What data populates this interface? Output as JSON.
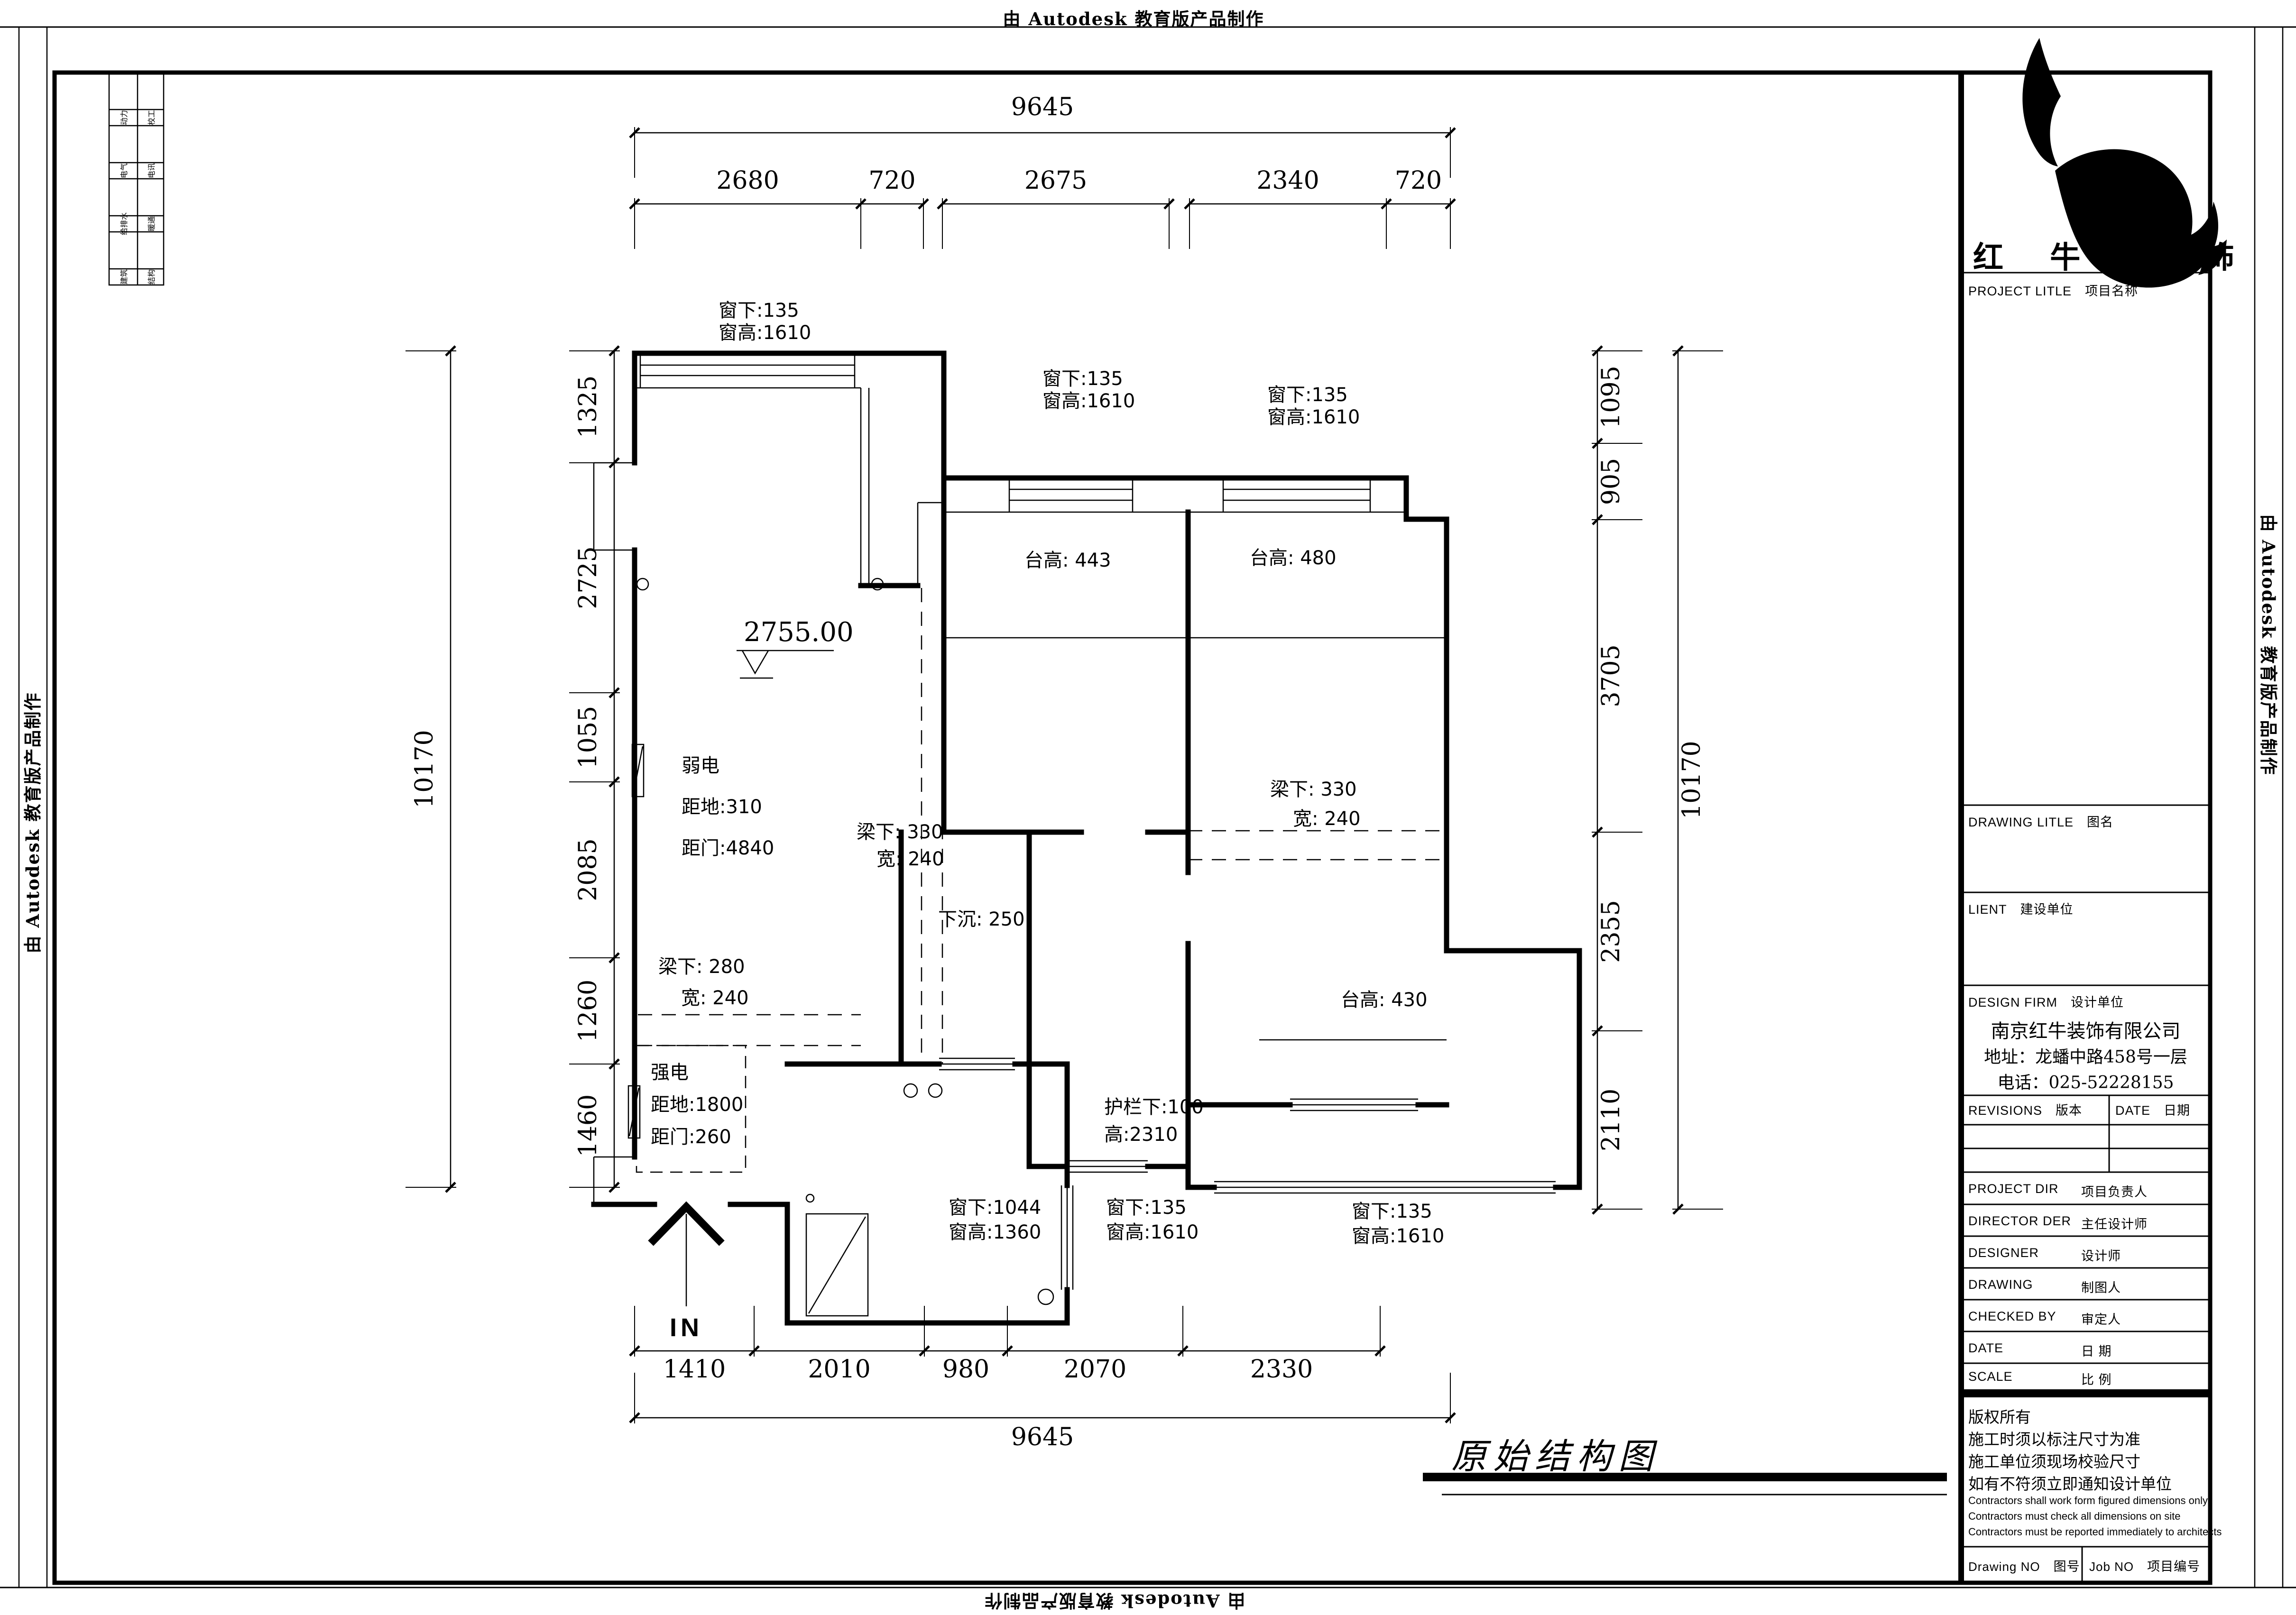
{
  "banners": {
    "top": "由 Autodesk 教育版产品制作",
    "bottom": "由 Autodesk 教育版产品制作",
    "left": "由 Autodesk 教育版产品制作",
    "right": "由 Autodesk 教育版产品制作"
  },
  "discipline_table": {
    "col1": [
      "动力",
      "电气",
      "给排水",
      "建筑"
    ],
    "col2": [
      "校工",
      "电讯",
      "暖通",
      "结构"
    ]
  },
  "title_block": {
    "brand": "红 牛 装 饰",
    "project_label": {
      "en": "PROJECT LITLE",
      "zh": "项目名称"
    },
    "drawing_label": {
      "en": "DRAWING LITLE",
      "zh": "图名"
    },
    "client_label": {
      "en": "LIENT",
      "zh": "建设单位"
    },
    "design_firm_label": {
      "en": "DESIGN FIRM",
      "zh": "设计单位"
    },
    "firm_info": [
      "南京红牛装饰有限公司",
      "地址：龙蟠中路458号一层",
      "电话：025-52228155"
    ],
    "revisions_label": {
      "en": "REVISIONS",
      "zh": "版本"
    },
    "date_col_label": {
      "en": "DATE",
      "zh": "日期"
    },
    "roles": [
      {
        "en": "PROJECT DIR",
        "zh": "项目负责人"
      },
      {
        "en": "DIRECTOR DER",
        "zh": "主任设计师"
      },
      {
        "en": "DESIGNER",
        "zh": "设计师"
      },
      {
        "en": "DRAWING",
        "zh": "制图人"
      },
      {
        "en": "CHECKED BY",
        "zh": "审定人"
      },
      {
        "en": "DATE",
        "zh": "日  期"
      },
      {
        "en": "SCALE",
        "zh": "比  例"
      }
    ],
    "copyright_notes": [
      "版权所有",
      "施工时须以标注尺寸为准",
      "施工单位须现场校验尺寸",
      "如有不符须立即通知设计单位"
    ],
    "english_notes": [
      "Contractors shall work form figured dimensions only",
      "Contractors must check all dimensions on site",
      "Contractors must be reported immediately to architects"
    ],
    "drawing_no_label": {
      "en": "Drawing NO",
      "zh": "图号"
    },
    "job_no_label": {
      "en": "Job NO",
      "zh": "项目编号"
    }
  },
  "drawing": {
    "title": "原始结构图",
    "level_mark": "2755.00",
    "entrance_label": "IN",
    "dimensions": {
      "top_overall": "9645",
      "top_segments": [
        "2680",
        "720",
        "2675",
        "2340",
        "720"
      ],
      "bottom_segments": [
        "1410",
        "2010",
        "980",
        "2070",
        "2330"
      ],
      "bottom_overall": "9645",
      "left_overall": "10170",
      "left_segments": [
        "1325",
        "2725",
        "1055",
        "2085",
        "1260",
        "1460"
      ],
      "right_segments": [
        "1095",
        "905",
        "3705",
        "2355",
        "2110"
      ],
      "right_overall": "10170"
    },
    "annotations": [
      {
        "name": "window-living",
        "lines": [
          "窗下:135",
          "窗高:1610"
        ]
      },
      {
        "name": "window-bedroom1",
        "lines": [
          "窗下:135",
          "窗高:1610"
        ]
      },
      {
        "name": "window-bedroom2",
        "lines": [
          "窗下:135",
          "窗高:1610"
        ]
      },
      {
        "name": "sill-bedroom1",
        "lines": [
          "台高: 443"
        ]
      },
      {
        "name": "sill-bedroom2",
        "lines": [
          "台高: 480"
        ]
      },
      {
        "name": "weak-current",
        "lines": [
          "弱电",
          "距地:310",
          "距门:4840"
        ]
      },
      {
        "name": "beam-center",
        "lines": [
          "梁下: 330",
          "宽: 240"
        ]
      },
      {
        "name": "beam-right",
        "lines": [
          "梁下: 330",
          "宽: 240"
        ]
      },
      {
        "name": "beam-left",
        "lines": [
          "梁下: 280",
          "宽: 240"
        ]
      },
      {
        "name": "sunken",
        "lines": [
          "下沉: 250"
        ]
      },
      {
        "name": "strong-current",
        "lines": [
          "强电",
          "距地:1800",
          "距门:260"
        ]
      },
      {
        "name": "guardrail",
        "lines": [
          "护栏下:100",
          "高:2310"
        ]
      },
      {
        "name": "window-bath",
        "lines": [
          "窗下:1044",
          "窗高:1360"
        ]
      },
      {
        "name": "window-bath-side",
        "lines": [
          "窗下:135",
          "窗高:1610"
        ]
      },
      {
        "name": "window-balcony",
        "lines": [
          "窗下:135",
          "窗高:1610"
        ]
      },
      {
        "name": "sill-bedroom2-low",
        "lines": [
          "台高: 430"
        ]
      }
    ]
  }
}
